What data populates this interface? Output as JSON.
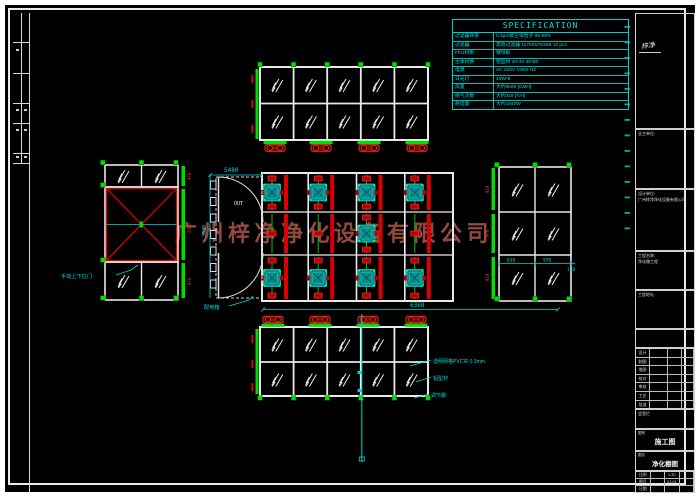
{
  "watermark": {
    "text": "广州梓净净化设备有限公司",
    "color": "#92493f"
  },
  "spec_table": {
    "title": "SPECIFICATION",
    "rows": [
      {
        "label": "过滤器效率",
        "value": "0.3μm级尘埃粒子 99.99%"
      },
      {
        "label": "过滤器",
        "value": "高效过滤器 1175X575X69 10 pcs"
      },
      {
        "label": "FFU材质",
        "value": "镀锌板"
      },
      {
        "label": "主体材质",
        "value": "铝型材 40*40 40*80"
      },
      {
        "label": "电源",
        "value": "AC 220V 1Φ50 HZ"
      },
      {
        "label": "日光灯",
        "value": "40W*8"
      },
      {
        "label": "风量",
        "value": "大约9600 [CMH]"
      },
      {
        "label": "换气次数",
        "value": "大约318 [T/H]"
      },
      {
        "label": "耗电量",
        "value": "大约1840W"
      }
    ]
  },
  "annotations": {
    "pvc_curtain": "透明网格PVC帘 0.3mm",
    "aluminum_profile": "铝型材",
    "adjust_foot": "调节脚",
    "manual_door": "手动上下拉门",
    "power_box": "配电箱",
    "out_label": "OUT"
  },
  "dimensions": {
    "plan_top": "5480",
    "plan_bottom": "6368",
    "plan_left": "3930",
    "right_elev": [
      "818",
      "970",
      "128"
    ],
    "left_strip": [
      "970",
      "2350",
      "970"
    ],
    "right_strip": [
      "818",
      "970",
      "818"
    ]
  },
  "title_block": {
    "logo_text": "梓净",
    "owner_label": "业主单位:",
    "design_label": "设计单位:",
    "design_value": "广州梓净净化设备有限公司",
    "project_label": "工程名称:",
    "project_value": "净化棚工程",
    "address_label": "工程地址:",
    "sign_rows": [
      "设计",
      "制图",
      "描图",
      "校对",
      "审核",
      "工艺",
      "批准"
    ],
    "note_label": "会签栏",
    "type_label": "图别",
    "type_value": "施工图",
    "name_label": "图名",
    "name_value": "净化棚图",
    "info_rows": [
      [
        "比例",
        "1:30"
      ],
      [
        "图号",
        "ZJ-01"
      ],
      [
        "日期",
        ""
      ]
    ]
  }
}
